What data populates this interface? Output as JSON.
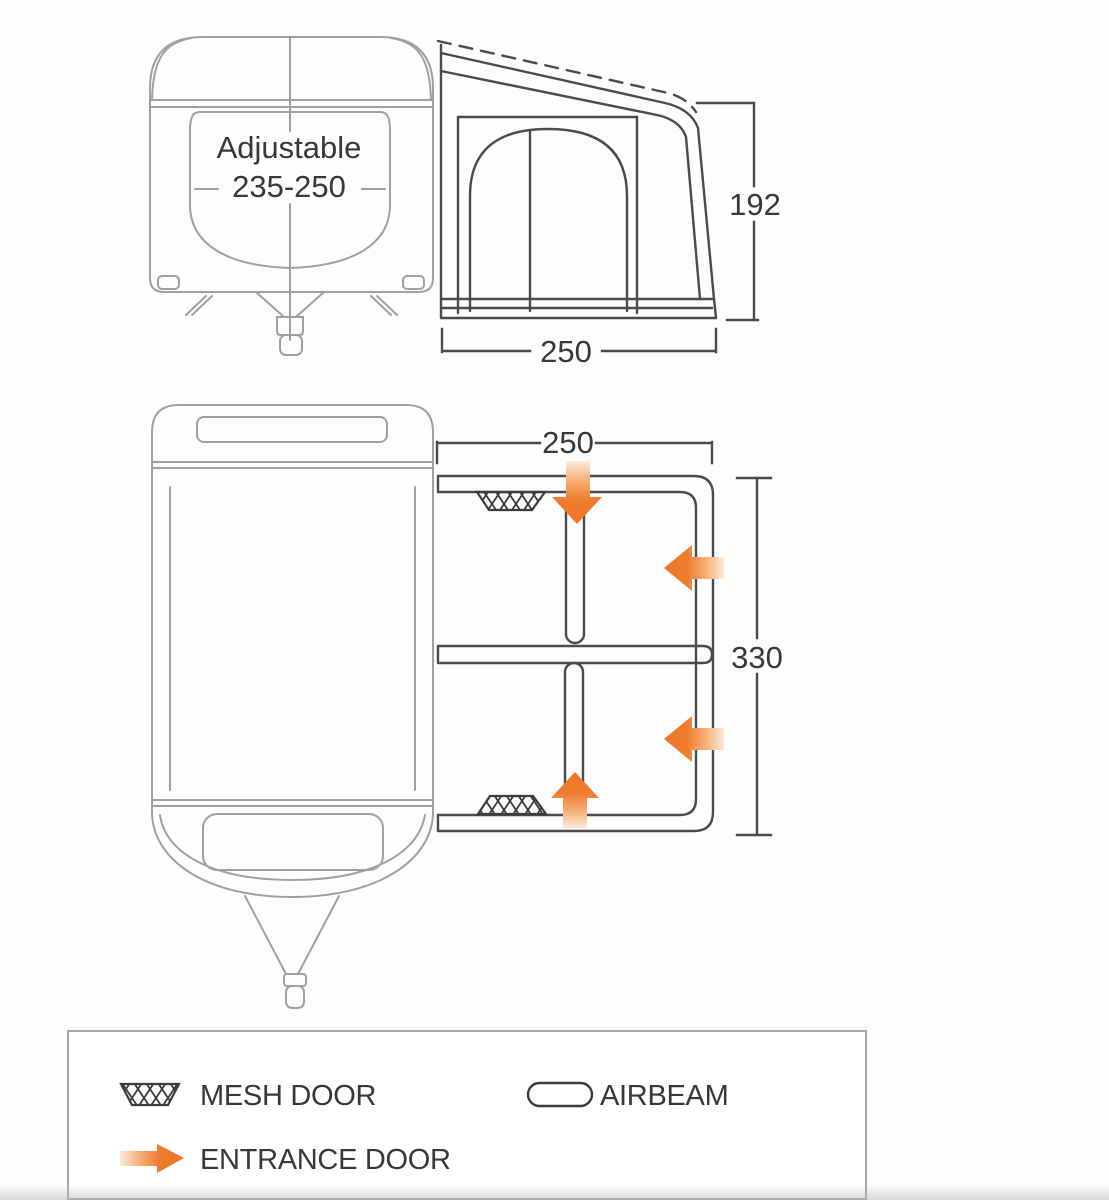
{
  "side_view": {
    "caravan_label_line1": "Adjustable",
    "caravan_label_line2": "235-250",
    "awning_height": "192",
    "awning_width": "250"
  },
  "plan_view": {
    "awning_width": "250",
    "awning_depth": "330"
  },
  "legend": {
    "mesh_door_label": "MESH DOOR",
    "airbeam_label": "AIRBEAM",
    "entrance_door_label": "ENTRANCE DOOR"
  },
  "colors": {
    "accent_orange": "#ee7c2e",
    "line_dark": "#4b4b4b",
    "line_light": "#a0a0a0"
  }
}
